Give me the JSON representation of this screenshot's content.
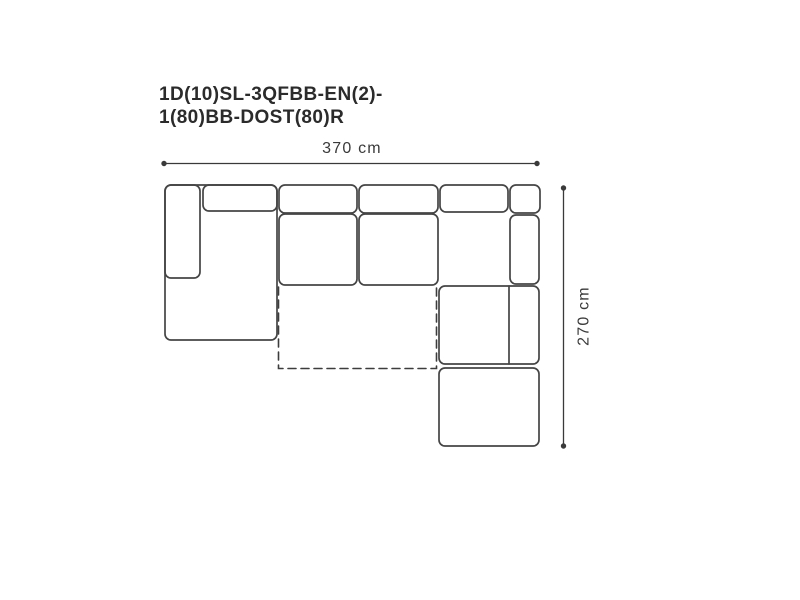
{
  "title": {
    "line1": "1D(10)SL-3QFBB-EN(2)-",
    "line2": "1(80)BB-DOST(80)R"
  },
  "dimensions": {
    "width_label": "370 cm",
    "height_label": "270 cm"
  },
  "colors": {
    "outline": "#454545",
    "dashed_outline": "#3d3d3d",
    "dimension": "#3a3a3a",
    "title_text": "#2b2b2b",
    "background": "#ffffff"
  },
  "diagram": {
    "type": "sofa-top-view-schematic",
    "modules": [
      "left-armrest",
      "chaise-longue",
      "back-cushion-left",
      "back-cushion-middle",
      "back-cushion-right",
      "seat-cushion-middle",
      "seat-cushion-right",
      "corner-back-cushion",
      "right-armrest-top",
      "right-armrest",
      "right-seat-section",
      "ottoman",
      "pull-out-bed"
    ]
  }
}
